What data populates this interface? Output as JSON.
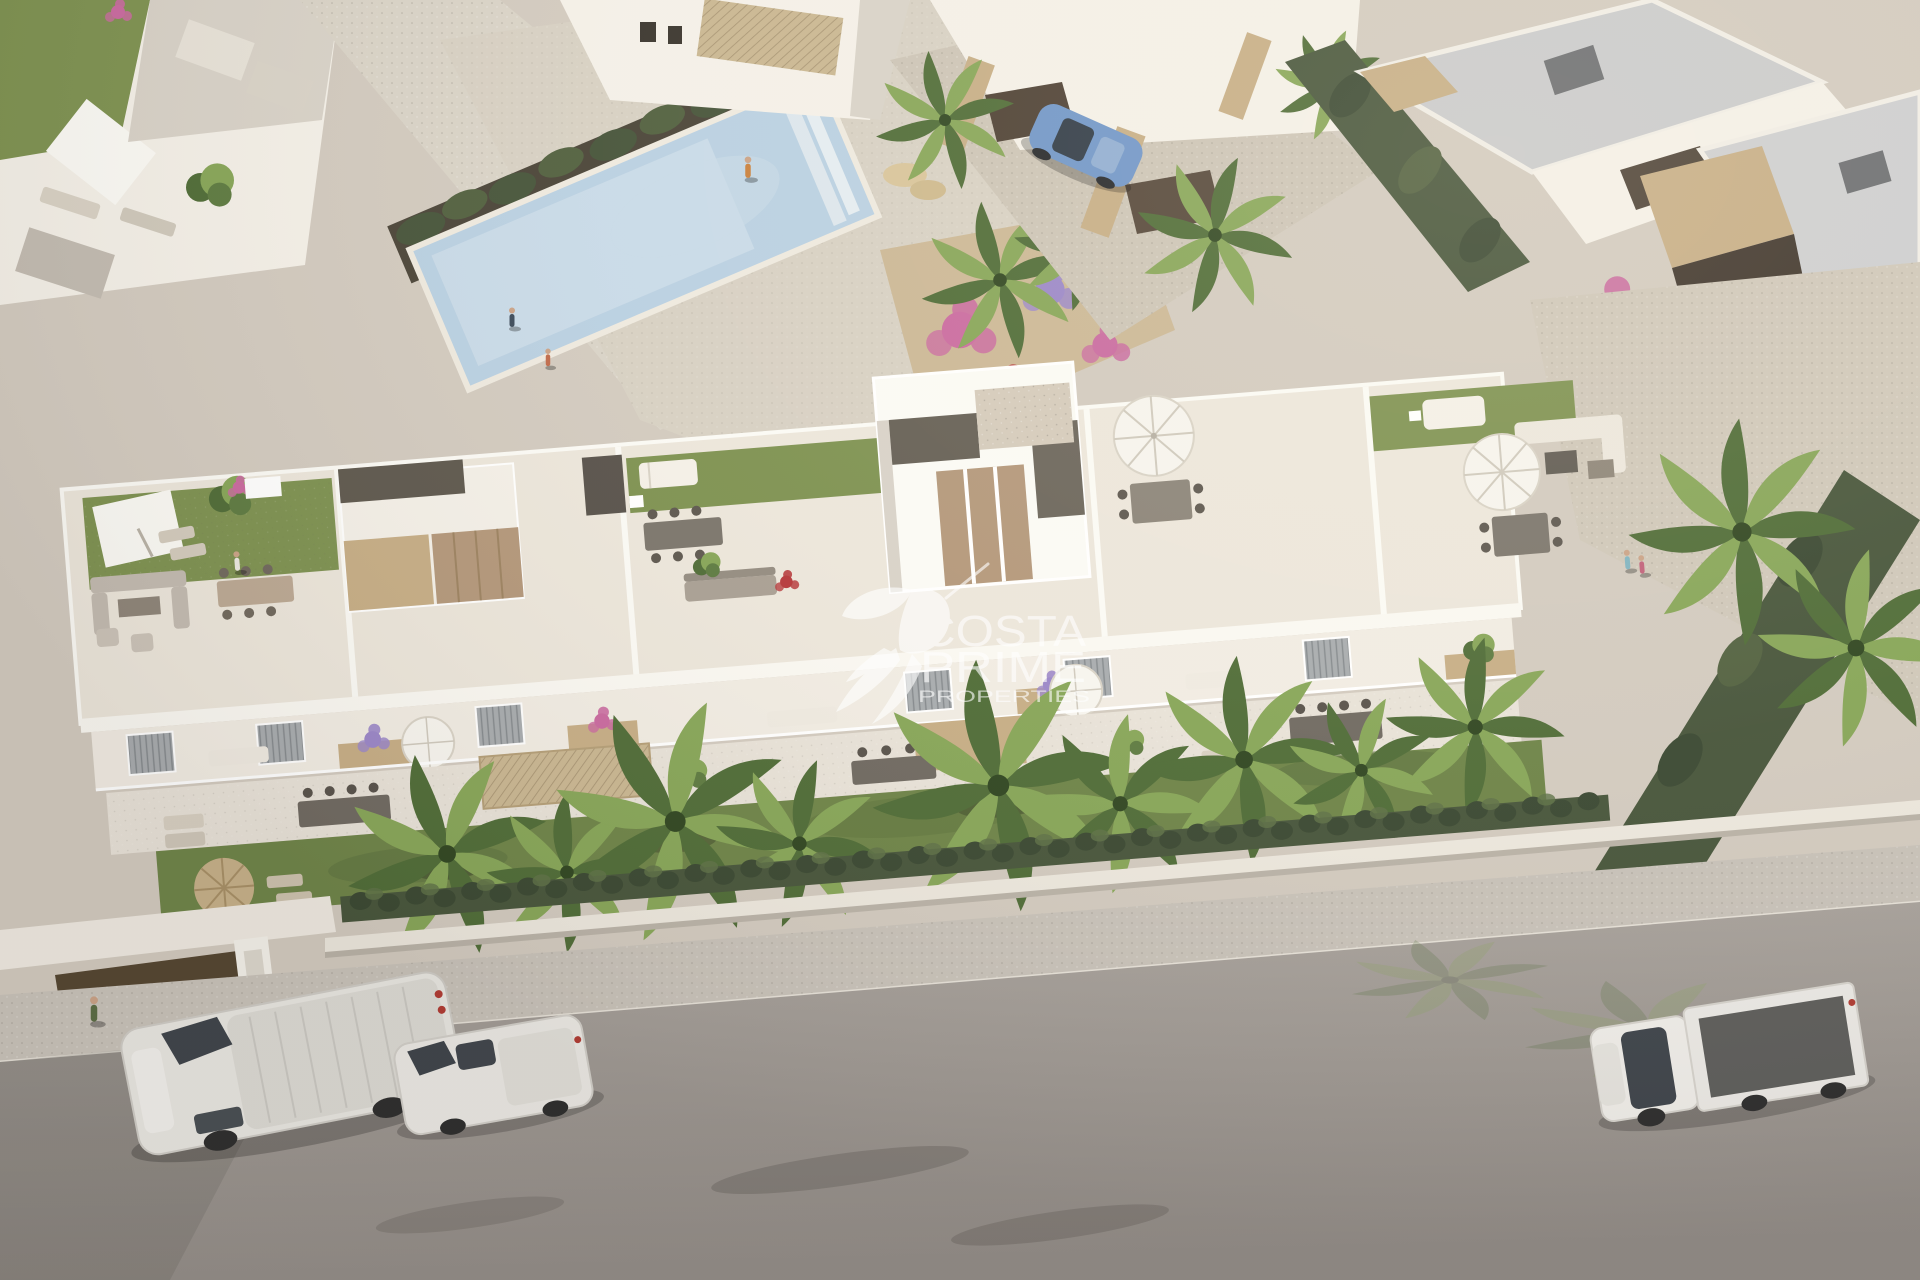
{
  "image": {
    "type": "aerial-3d-architectural-render",
    "subject": "Modern white Mediterranean residential complex with rooftop terraces, private gardens, communal pool, palm trees and street parking",
    "lighting": "warm afternoon sun from upper right, long soft shadows"
  },
  "watermark": {
    "icon": "hummingbird-icon",
    "line1": "COSTA",
    "line2": "PRIME",
    "line3": "PROPERTIES",
    "color": "#ffffff",
    "opacity": "0.62"
  },
  "scene": {
    "areas": {
      "top": "neighboring white villas with flat grey roofs, stone accents and communal pool",
      "middle": "main three-block apartment building with rooftop terraces (lawns, parasols, lounge furniture)",
      "bottom": "private gardens with palms, boundary hedge and wall, sidewalk and asphalt road"
    },
    "vehicles": [
      "white cargo van parked on road (left)",
      "white compact van parked on road (center-left)",
      "white flatbed pickup truck parked on road (right)",
      "blue hatchback in villa driveway (top)"
    ],
    "pool_people_visible": "3"
  },
  "palette": {
    "ground": "#d2cabf",
    "path": "#d9d3c7",
    "deck": "#d7d0c3",
    "poolWater": "#b9d0e2",
    "poolShallow": "#d6e2ec",
    "wallSun": "#f4f0e8",
    "wallBright": "#fbfaf5",
    "wallShade": "#d8d2c8",
    "wallDark": "#c2bbb1",
    "roofGray": "#c9cacc",
    "lawn": "#7d9150",
    "lawnDark": "#66793f",
    "gardenLawn": "#6d8347",
    "hedge": "#46543a",
    "hedgeDark": "#394731",
    "palmLight": "#86a557",
    "palmDark": "#4e6b36",
    "stone": "#c6ad85",
    "wood": "#b3977a",
    "mulch": "#4a4438",
    "pergola": "#5d574d",
    "thatch": "#c9b691",
    "furnGray": "#8d8478",
    "road": "#a39d97",
    "roadDark": "#8f8984",
    "sidewalk": "#c8c2b9",
    "vehicleWhite": "#e9e7e2",
    "glass": "#3d434a",
    "carBlue": "#6f95c8",
    "flowerPurple": "#9a86c8",
    "flowerPink": "#c9699f",
    "flowerRed": "#b5373a",
    "flowerOrange": "#cf7a4e",
    "shadow": "rgba(58,52,45,0.25)"
  }
}
